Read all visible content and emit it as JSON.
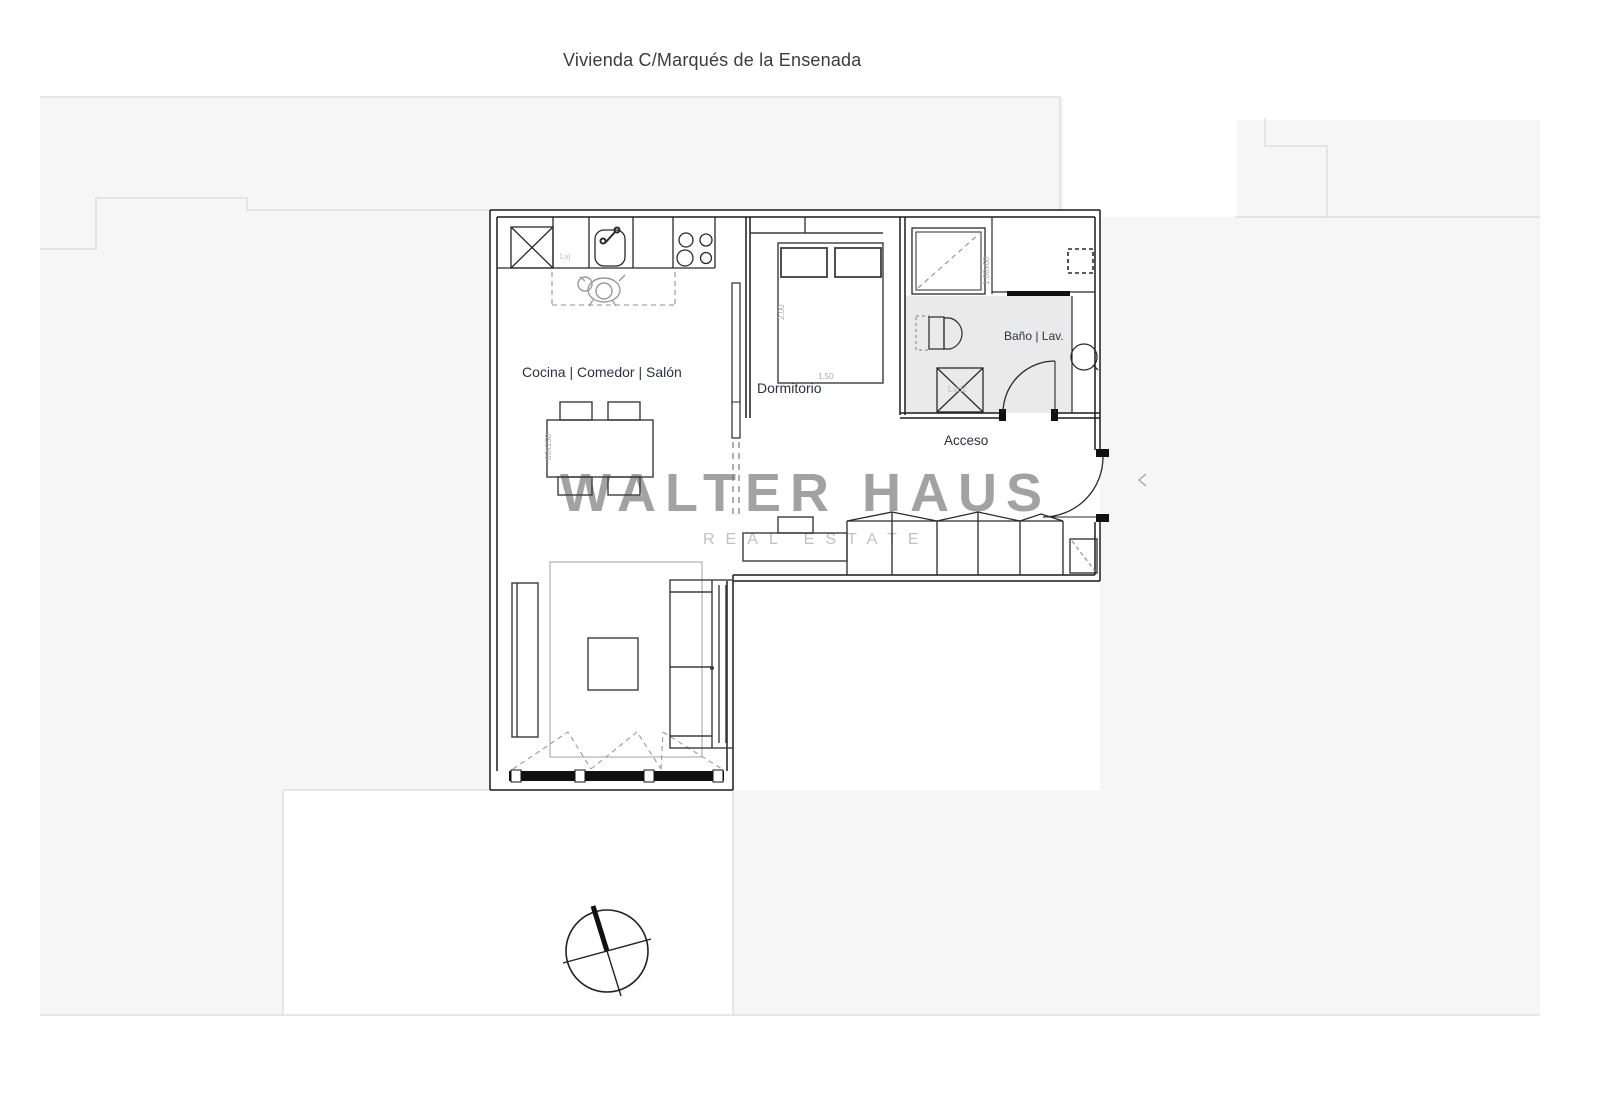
{
  "page": {
    "title": "Vivienda C/Marqués de la Ensenada"
  },
  "watermark": {
    "line1": "WALTER HAUS",
    "line2": "REAL ESTATE"
  },
  "rooms": {
    "kitchen_living": "Cocina | Comedor | Salón",
    "bedroom": "Dormitorio",
    "bathroom": "Baño | Lav.",
    "entry": "Acceso"
  },
  "annotations": {
    "bed_length": "2.00",
    "bed_width": "1.50",
    "table_size": "80x150",
    "counter_size": "1.88x60",
    "dishwasher": "Lvj",
    "washer": "Lvdc"
  },
  "colors": {
    "wall": "#1c1c1c",
    "furniture": "#3c3c3c",
    "context_fill": "#f6f6f6",
    "context_line": "#d9d9d9",
    "bath_floor": "#eaeaea",
    "watermark_gray": "#8e8e8e",
    "label_color": "#2a3342"
  }
}
